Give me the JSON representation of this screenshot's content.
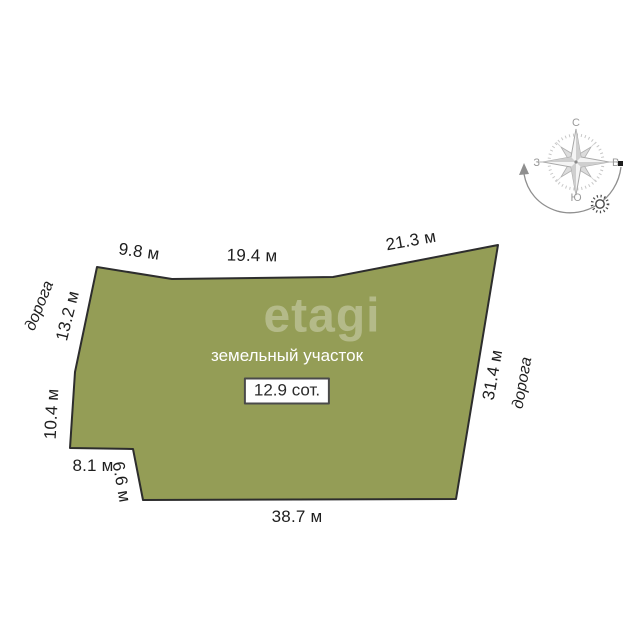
{
  "watermark": "etagi",
  "plot": {
    "title": "земельный участок",
    "area_label": "12.9 сот.",
    "fill_color": "#949d56",
    "stroke_color": "#2d2d2d",
    "polygon_points": "97,267 172,279 333,277 498,245 456,499 143,500 133,449 70,448 75,372"
  },
  "dimensions": {
    "top1": "9.8 м",
    "top2": "19.4 м",
    "top3": "21.3 м",
    "left_upper": "13.2 м",
    "left_lower": "10.4 м",
    "notch_horizontal": "8.1 м",
    "notch_vertical": "6.6 м",
    "bottom": "38.7 м",
    "right": "31.4 м"
  },
  "roads": {
    "left": "дорога",
    "right": "дорога"
  },
  "compass": {
    "north": "С",
    "east": "В",
    "south": "Ю",
    "west": "З"
  }
}
